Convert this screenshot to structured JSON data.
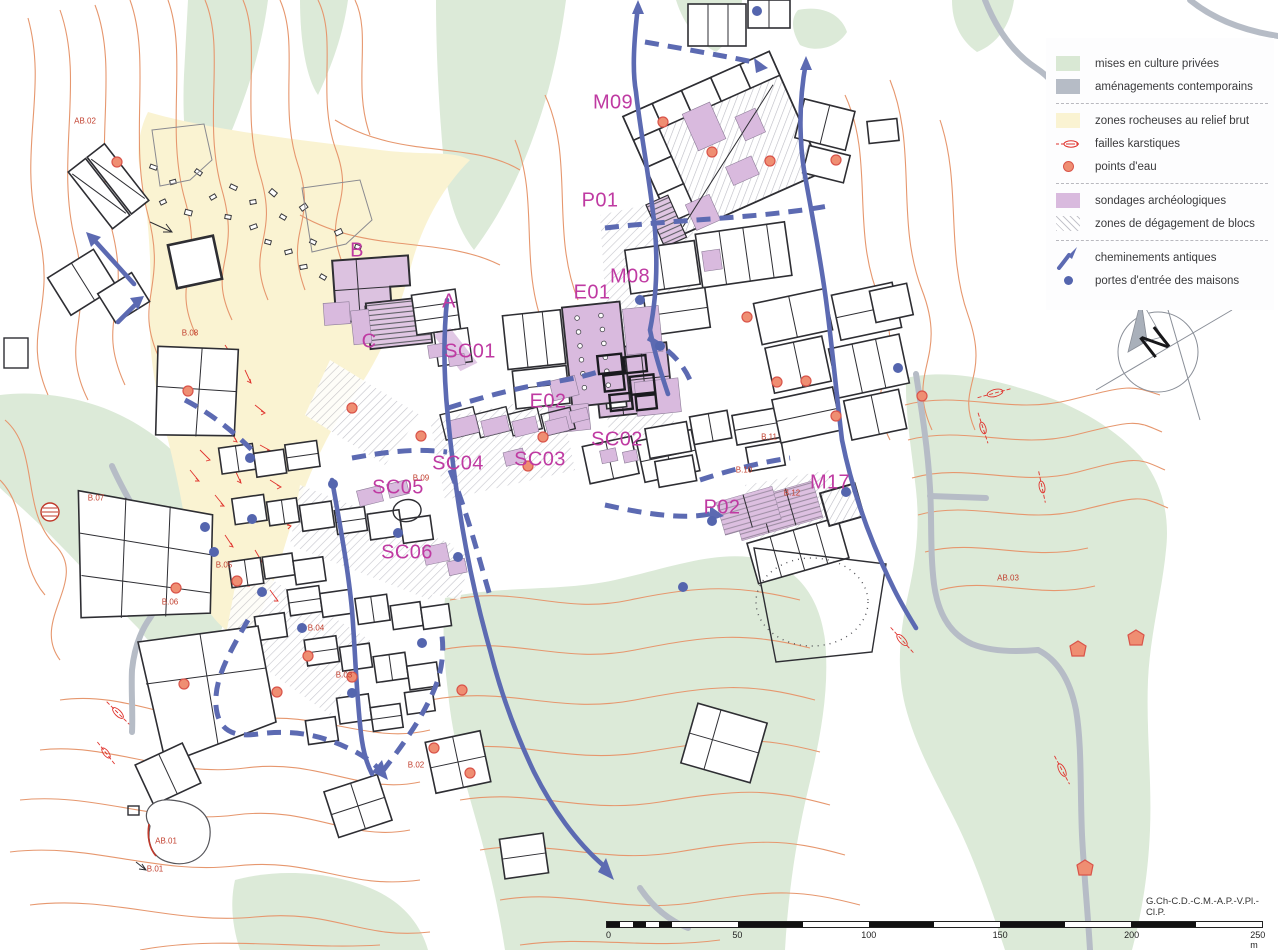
{
  "legend": {
    "items": [
      {
        "label": "mises en culture privées",
        "swatch": "green-fill",
        "color": "#d9e8d4"
      },
      {
        "label": "aménagements contemporains",
        "swatch": "gray-fill",
        "color": "#b6bcc6"
      },
      {
        "label": "zones rocheuses au relief brut",
        "swatch": "yellow-fill",
        "color": "#faf3d2"
      },
      {
        "label": "failles karstiques",
        "swatch": "red-faille-symbol",
        "color": "#e0342e"
      },
      {
        "label": "points d'eau",
        "swatch": "orange-dot",
        "color": "#ef8e72"
      },
      {
        "label": "sondages archéologiques",
        "swatch": "purple-fill",
        "color": "#d9bade"
      },
      {
        "label": "zones de dégagement de blocs",
        "swatch": "hatch-fill",
        "color": "#c5c5cc"
      },
      {
        "label": "cheminements antiques",
        "swatch": "blue-path-symbol",
        "color": "#5c6ab2"
      },
      {
        "label": "portes d'entrée des maisons",
        "swatch": "blue-dot",
        "color": "#5465ae"
      }
    ]
  },
  "compass": {
    "north_label": "N"
  },
  "scale_bar": {
    "ticks": [
      "0",
      "50",
      "100",
      "150",
      "200",
      "250 m"
    ]
  },
  "credit": "G.Ch-C.D.-C.M.-A.P.-V.Pl.-Cl.P.",
  "map_labels": {
    "sectors": [
      {
        "text": "M09"
      },
      {
        "text": "P01"
      },
      {
        "text": "M08"
      },
      {
        "text": "E01"
      },
      {
        "text": "E02"
      },
      {
        "text": "SC01"
      },
      {
        "text": "SC02"
      },
      {
        "text": "SC03"
      },
      {
        "text": "SC04"
      },
      {
        "text": "SC05"
      },
      {
        "text": "SC06"
      },
      {
        "text": "A"
      },
      {
        "text": "B"
      },
      {
        "text": "C"
      },
      {
        "text": "P02"
      },
      {
        "text": "M17"
      }
    ],
    "features": [
      {
        "text": "AB.02"
      },
      {
        "text": "B.08"
      },
      {
        "text": "B.07"
      },
      {
        "text": "B.05"
      },
      {
        "text": "B.06"
      },
      {
        "text": "B.09"
      },
      {
        "text": "B.04"
      },
      {
        "text": "B.03"
      },
      {
        "text": "B.02"
      },
      {
        "text": "AB.01"
      },
      {
        "text": "B.01"
      },
      {
        "text": "B.11"
      },
      {
        "text": "B.10"
      },
      {
        "text": "B.12"
      },
      {
        "text": "AB.03"
      }
    ]
  }
}
